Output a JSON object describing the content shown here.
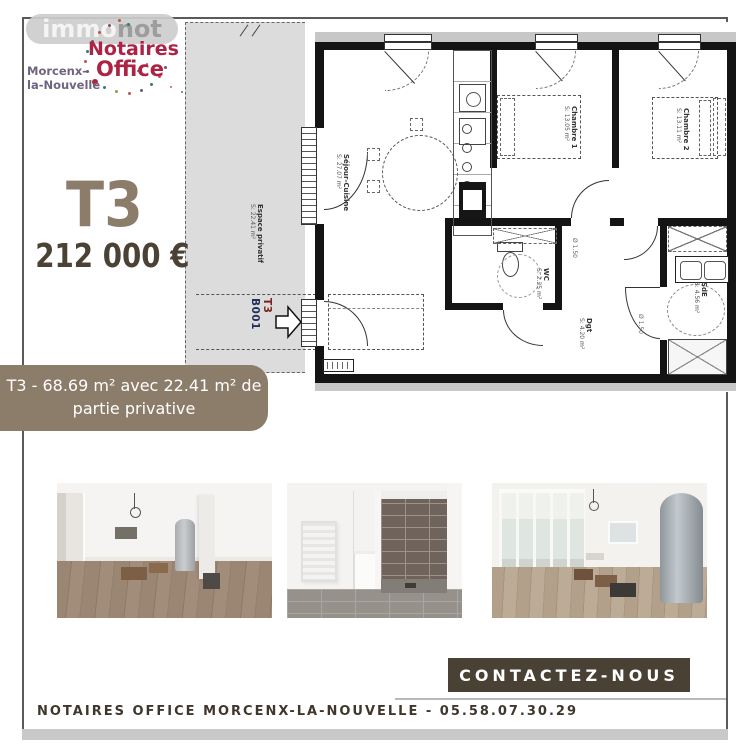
{
  "brand": {
    "immonot": {
      "part1": "immo",
      "part2": "not"
    },
    "notaires_office": {
      "line1": "Notaires",
      "line2": "Office",
      "location_line1": "Morcenx-",
      "location_line2": "la-Nouvelle"
    }
  },
  "listing": {
    "type": "T3",
    "price": "212 000 €",
    "banner": {
      "line1": "T3 - 68.69 m²  avec 22.41 m² de",
      "line2": "partie privative"
    }
  },
  "floorplan": {
    "unit_code": "B001",
    "unit_type": "T3",
    "rooms": {
      "espace_privatif": {
        "name": "Espace privatif",
        "area": "S: 22.41 m²"
      },
      "sejour": {
        "name": "Séjour-Cuisine",
        "area": "S: 27.07 m²"
      },
      "chambre1": {
        "name": "Chambre 1",
        "area": "S: 13.05 m²"
      },
      "chambre2": {
        "name": "Chambre 2",
        "area": "S: 13.11 m²"
      },
      "wc": {
        "name": "WC",
        "area": "S: 2.25 m²"
      },
      "dgt": {
        "name": "Dgt",
        "area": "S: 4.20 m²"
      },
      "sde": {
        "name": "SdE",
        "area": "S: 4.56 m²"
      }
    },
    "annotations": {
      "pmr": "Ø 1.50"
    }
  },
  "contact": {
    "button": "CONTACTEZ-NOUS",
    "footer": "NOTAIRES OFFICE MORCENX-LA-NOUVELLE - 05.58.07.30.29"
  },
  "colors": {
    "brand_taupe": "#8c7c6a",
    "dark_brown": "#4a4135",
    "type_taupe": "#8c7d6b",
    "accent_crimson": "#ac2346",
    "location_purple": "#6e6480",
    "plan_navy": "#243059",
    "plan_red": "#7d2020",
    "frame_gray": "#5a5a5a"
  }
}
